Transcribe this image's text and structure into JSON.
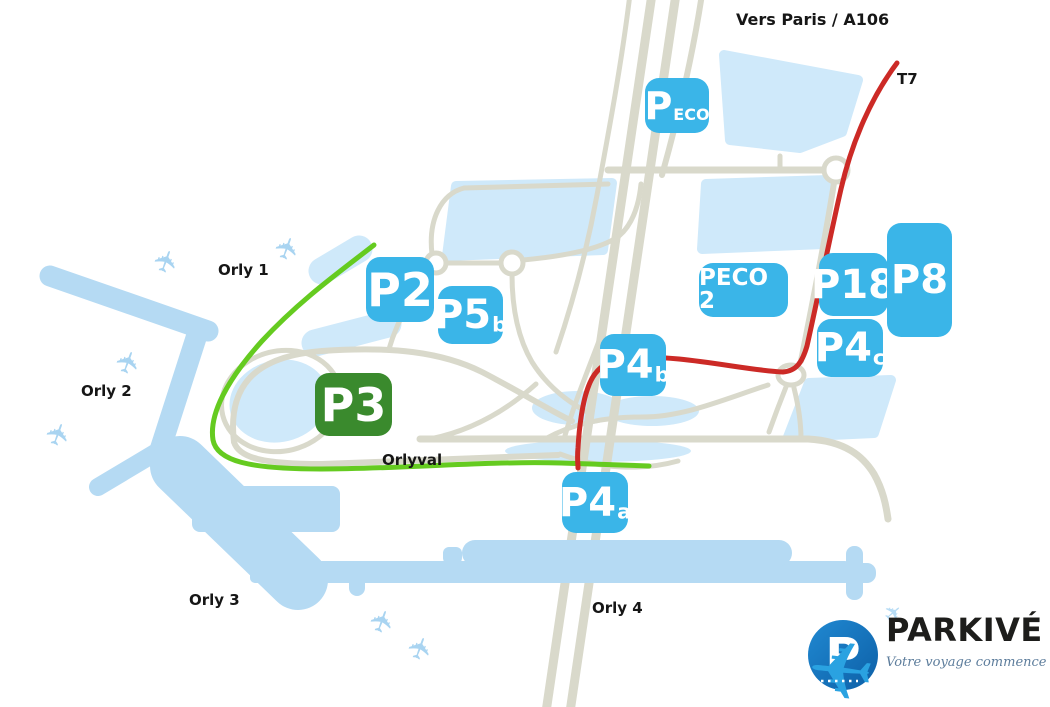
{
  "map": {
    "direction_label": "Vers Paris / A106",
    "tram_line_label": "T7",
    "orlyval_line_label": "Orlyval",
    "terminal_labels": [
      "Orly 1",
      "Orly 2",
      "Orly 3",
      "Orly 4"
    ],
    "parkings": [
      {
        "id": "peco",
        "name": "P",
        "sub": "ECO",
        "badge_color": "#3ab5e8"
      },
      {
        "id": "p2",
        "name": "P2",
        "sub": "",
        "badge_color": "#3ab5e8"
      },
      {
        "id": "p5b",
        "name": "P5",
        "sub": "b",
        "badge_color": "#3ab5e8"
      },
      {
        "id": "peco2",
        "name": "PECO 2",
        "sub": "",
        "badge_color": "#3ab5e8"
      },
      {
        "id": "p18",
        "name": "P18",
        "sub": "",
        "badge_color": "#3ab5e8"
      },
      {
        "id": "p8",
        "name": "P8",
        "sub": "",
        "badge_color": "#3ab5e8"
      },
      {
        "id": "p4c",
        "name": "P4",
        "sub": "c",
        "badge_color": "#3ab5e8"
      },
      {
        "id": "p4b",
        "name": "P4",
        "sub": "b",
        "badge_color": "#3ab5e8"
      },
      {
        "id": "p3",
        "name": "P3",
        "sub": "",
        "badge_color": "#3a8a2d"
      },
      {
        "id": "p4a",
        "name": "P4",
        "sub": "a",
        "badge_color": "#3ab5e8"
      }
    ],
    "colors": {
      "parking_badge_blue": "#3ab5e8",
      "parking_badge_green": "#3a8a2d",
      "orlyval_line_green": "#65cb20",
      "t7_line_red": "#cc2a26",
      "terminal_building_blue": "#b5daf3",
      "parking_area_blue": "#cfe9fa",
      "road_beige": "#d9d9cb"
    },
    "icons": {
      "airplane": "✈"
    }
  },
  "logo": {
    "brand": "PARKIVÉ",
    "logo_letter": "P",
    "tagline": "Votre voyage commence bien!"
  }
}
